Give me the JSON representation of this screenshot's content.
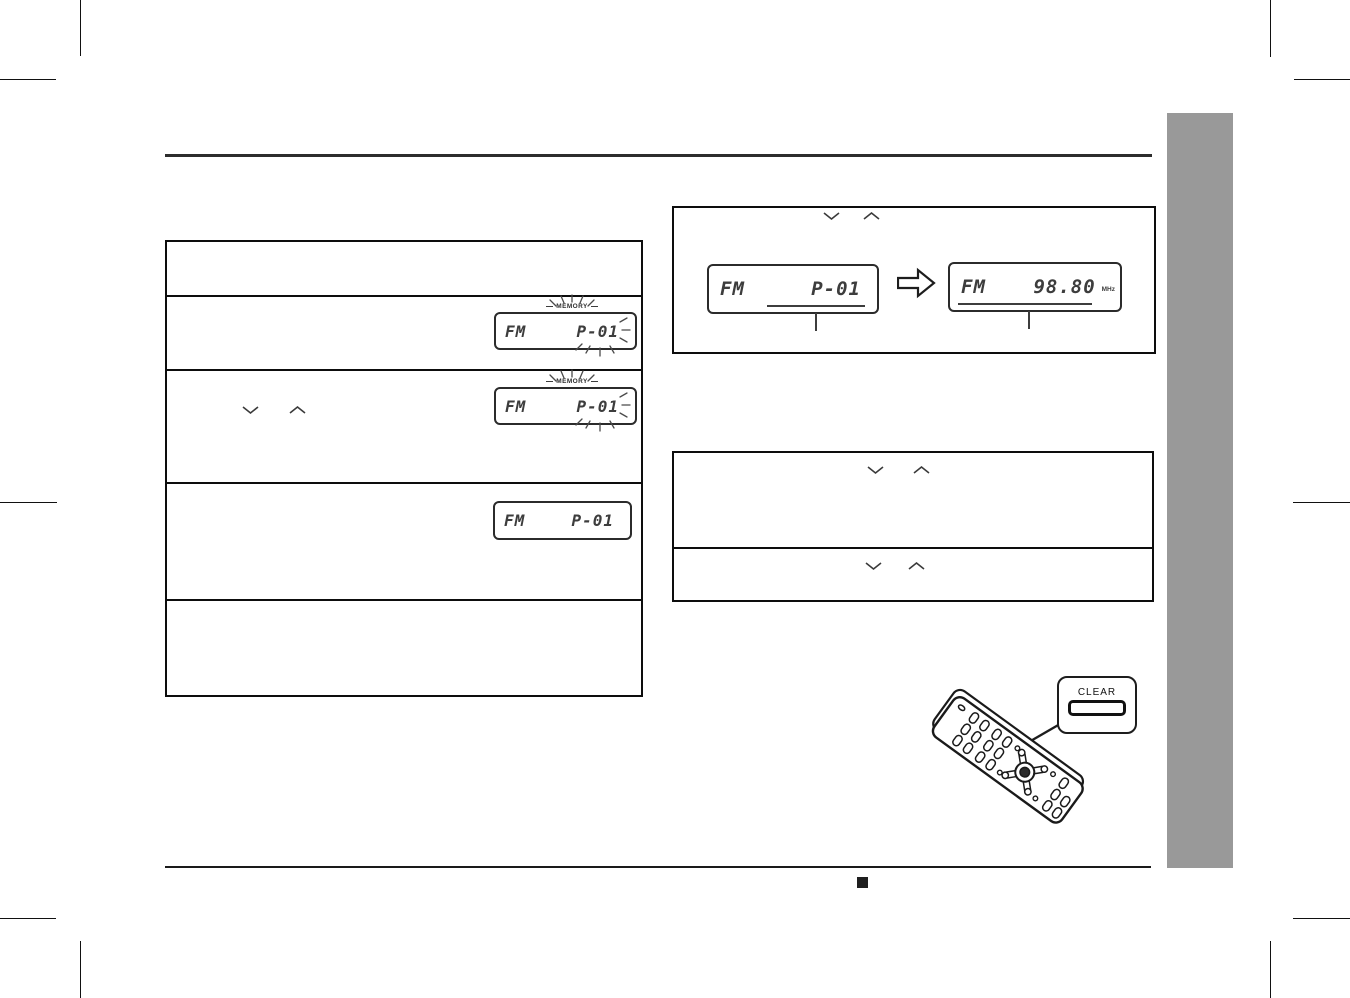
{
  "displays": {
    "store_flash": {
      "band": "FM",
      "value": "P-01",
      "memory": "MEMORY"
    },
    "select_flash": {
      "band": "FM",
      "value": "P-01",
      "memory": "MEMORY"
    },
    "stored": {
      "band": "FM",
      "value": "P-01"
    },
    "recall_preset": {
      "band": "FM",
      "value": "P-01"
    },
    "recall_freq": {
      "band": "FM",
      "value": "98.80",
      "unit": "MHz"
    }
  },
  "remote_callout": {
    "button_label": "CLEAR"
  },
  "colors": {
    "sidebar_gray": "#999999",
    "rule_dark": "#2d2d2d",
    "ink": "#1a1a1a"
  }
}
